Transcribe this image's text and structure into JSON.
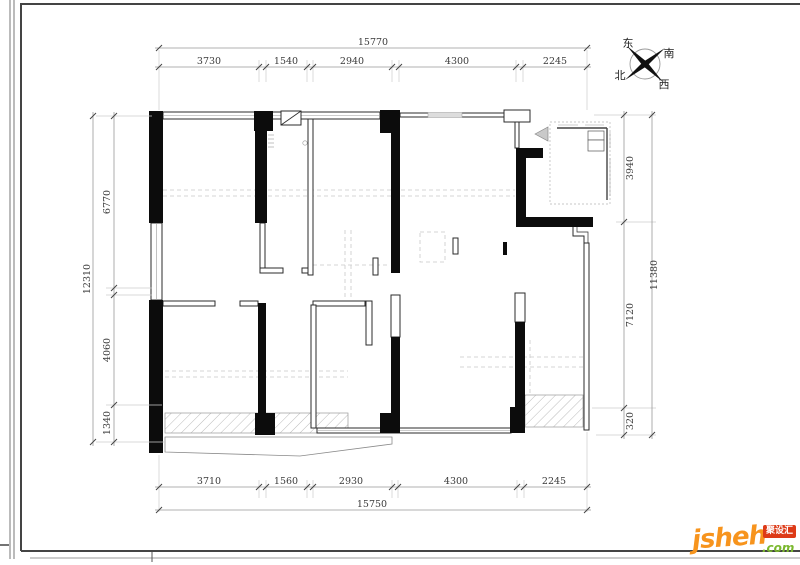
{
  "sheet": {
    "dimensions": {
      "top": {
        "total": "15770",
        "segments": [
          "3730",
          "1540",
          "2940",
          "4300",
          "2245"
        ]
      },
      "bottom": {
        "total": "15750",
        "segments": [
          "3710",
          "1560",
          "2930",
          "4300",
          "2245"
        ]
      },
      "left": {
        "total": "12310",
        "segments": [
          "6770",
          "4060",
          "1340"
        ]
      },
      "right": {
        "total": "11380",
        "segments": [
          "3940",
          "7120",
          "320"
        ]
      }
    },
    "compass": {
      "east": "东",
      "south": "南",
      "west": "西",
      "north": "北"
    }
  },
  "branding": {
    "logo_text": "jsheh",
    "logo_suffix": ".com",
    "badge_text": "聚设汇",
    "colors": {
      "logo_orange": "#f7941d",
      "logo_green": "#7ab82e",
      "badge_red": "#dd3a17"
    }
  }
}
